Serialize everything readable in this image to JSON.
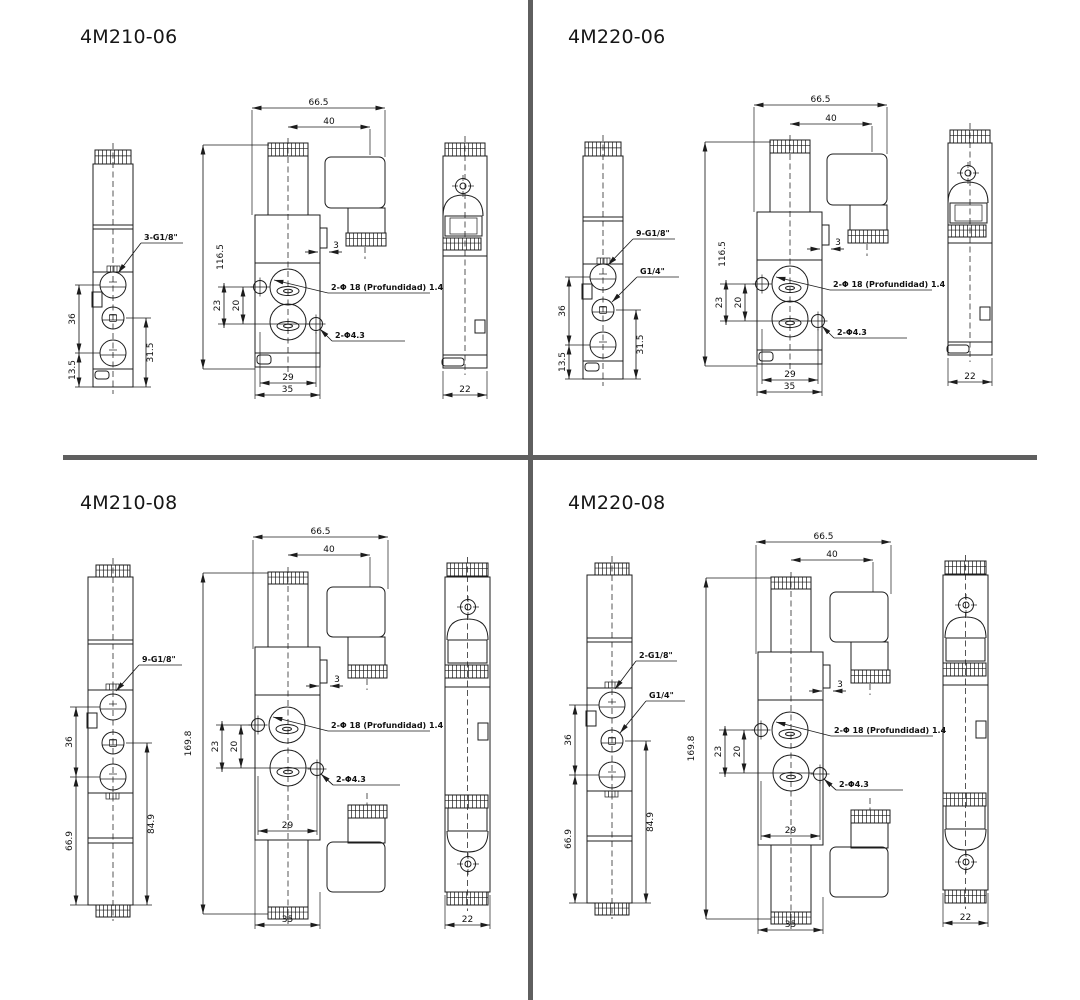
{
  "page_background": "#ffffff",
  "divider_color": "#5f5f5f",
  "line_color": "#1c1c1c",
  "models": [
    {
      "name": "4M210-06",
      "coil_type": "single",
      "side_view": {
        "port_label_1": "3-G1/8\"",
        "dim_port_span": "36",
        "dim_bottom_offset": "13.5",
        "dim_lower_span": "31.5"
      },
      "front_view": {
        "dim_overall_width": "66.5",
        "dim_connector_offset": "40",
        "dim_height": "116.5",
        "dim_port_spacing_outer": "23",
        "dim_port_spacing_inner": "20",
        "dim_pilot_tab": "3",
        "dim_mount_hole_span": "29",
        "dim_body_width": "35",
        "label_counterbore": "2-Φ 18 (Profundidad) 1.4",
        "label_mount_holes": "2-Φ4.3"
      },
      "end_view": {
        "dim_width": "22"
      }
    },
    {
      "name": "4M220-06",
      "coil_type": "single",
      "side_view": {
        "port_label_1": "9-G1/8\"",
        "port_label_2": "G1/4\"",
        "dim_port_span": "36",
        "dim_bottom_offset": "13.5",
        "dim_lower_span": "31.5"
      },
      "front_view": {
        "dim_overall_width": "66.5",
        "dim_connector_offset": "40",
        "dim_height": "116.5",
        "dim_port_spacing_outer": "23",
        "dim_port_spacing_inner": "20",
        "dim_pilot_tab": "3",
        "dim_mount_hole_span": "29",
        "dim_body_width": "35",
        "label_counterbore": "2-Φ 18 (Profundidad) 1.4",
        "label_mount_holes": "2-Φ4.3"
      },
      "end_view": {
        "dim_width": "22"
      }
    },
    {
      "name": "4M210-08",
      "coil_type": "double",
      "side_view": {
        "port_label_1": "9-G1/8\"",
        "dim_port_span": "36",
        "dim_bottom_offset": "66.9",
        "dim_lower_span": "84.9"
      },
      "front_view": {
        "dim_overall_width": "66.5",
        "dim_connector_offset": "40",
        "dim_height": "169.8",
        "dim_port_spacing_outer": "23",
        "dim_port_spacing_inner": "20",
        "dim_pilot_tab": "3",
        "dim_mount_hole_span": "29",
        "dim_body_width": "35",
        "label_counterbore": "2-Φ 18 (Profundidad) 1.4",
        "label_mount_holes": "2-Φ4.3"
      },
      "end_view": {
        "dim_width": "22"
      }
    },
    {
      "name": "4M220-08",
      "coil_type": "double",
      "side_view": {
        "port_label_1": "2-G1/8\"",
        "port_label_2": "G1/4\"",
        "dim_port_span": "36",
        "dim_bottom_offset": "66.9",
        "dim_lower_span": "84.9"
      },
      "front_view": {
        "dim_overall_width": "66.5",
        "dim_connector_offset": "40",
        "dim_height": "169.8",
        "dim_port_spacing_outer": "23",
        "dim_port_spacing_inner": "20",
        "dim_pilot_tab": "3",
        "dim_mount_hole_span": "29",
        "dim_body_width": "35",
        "label_counterbore": "2-Φ 18 (Profundidad) 1.4",
        "label_mount_holes": "2-Φ4.3"
      },
      "end_view": {
        "dim_width": "22"
      }
    }
  ]
}
